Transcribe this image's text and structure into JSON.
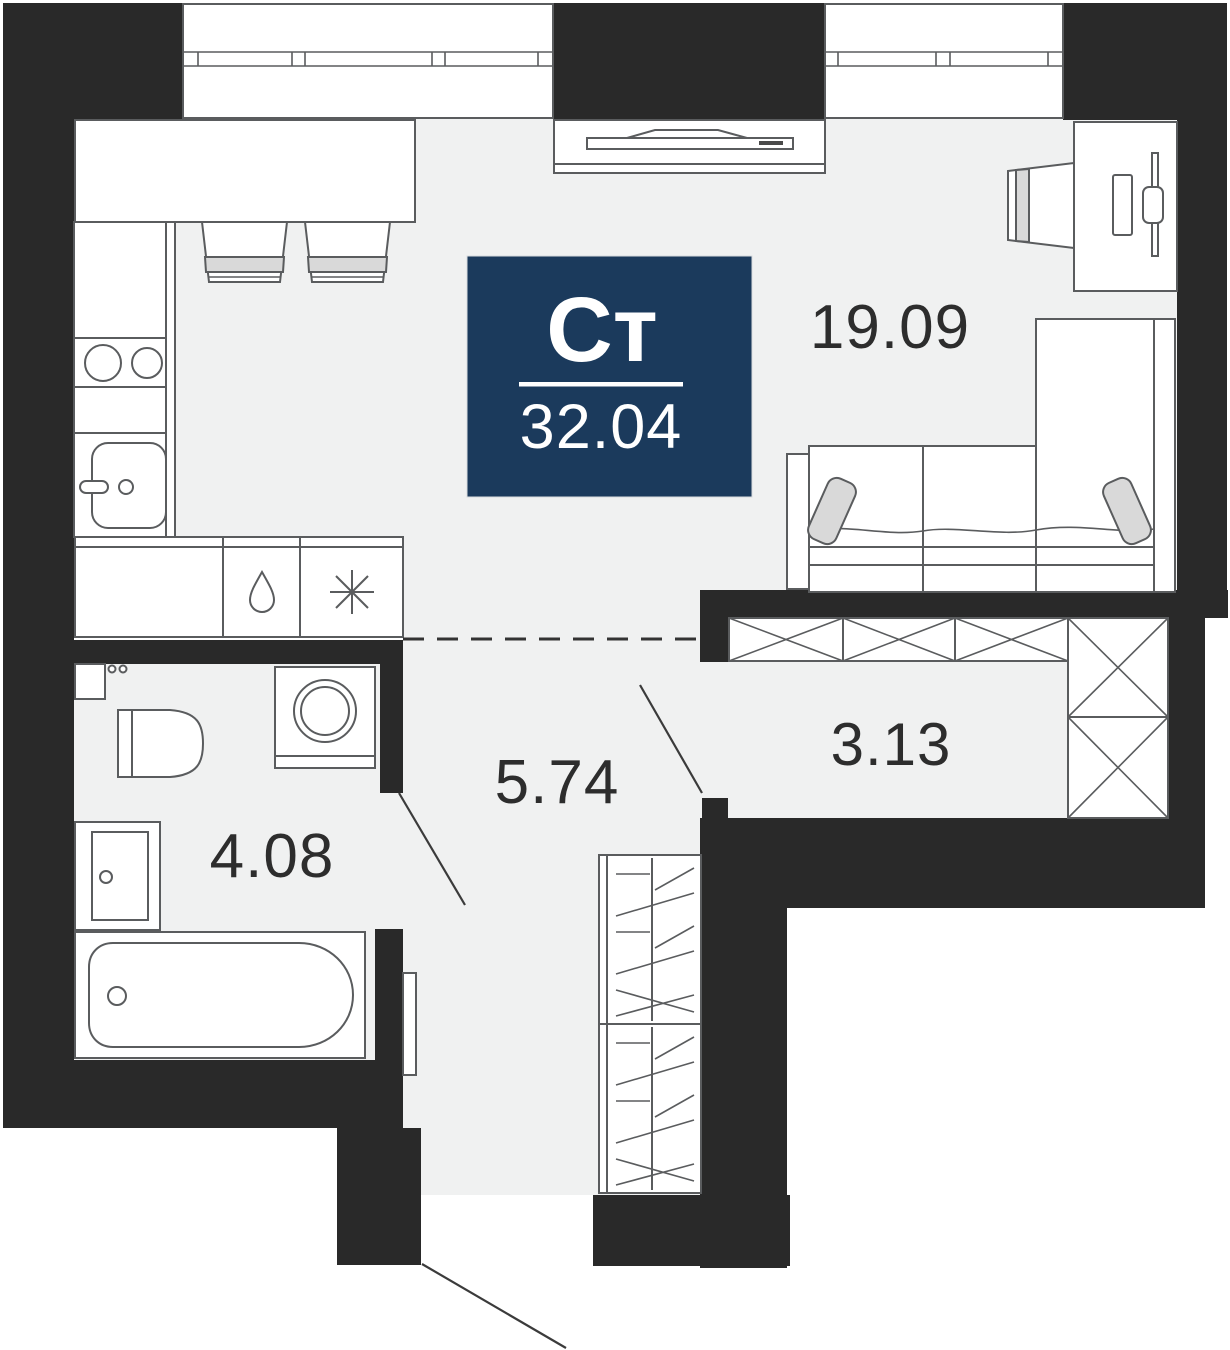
{
  "floorplan": {
    "badge": {
      "type_label": "Ст",
      "area_value": "32.04"
    },
    "rooms": [
      {
        "id": "living-kitchen",
        "area_label": "19.09"
      },
      {
        "id": "hallway",
        "area_label": "5.74"
      },
      {
        "id": "bathroom",
        "area_label": "4.08"
      },
      {
        "id": "wardrobe",
        "area_label": "3.13"
      }
    ],
    "icons": [
      {
        "name": "water-drop-icon",
        "meaning": "dishwasher compartment"
      },
      {
        "name": "snowflake-icon",
        "meaning": "refrigerator compartment"
      }
    ],
    "colors": {
      "wall": "#292929",
      "floor": "#f0f1f1",
      "outline": "#5a5c5e",
      "badge_bg": "#1b3a5c",
      "badge_text": "#ffffff",
      "label": "#2d2d2d",
      "cushion": "#d9d9d9"
    }
  }
}
